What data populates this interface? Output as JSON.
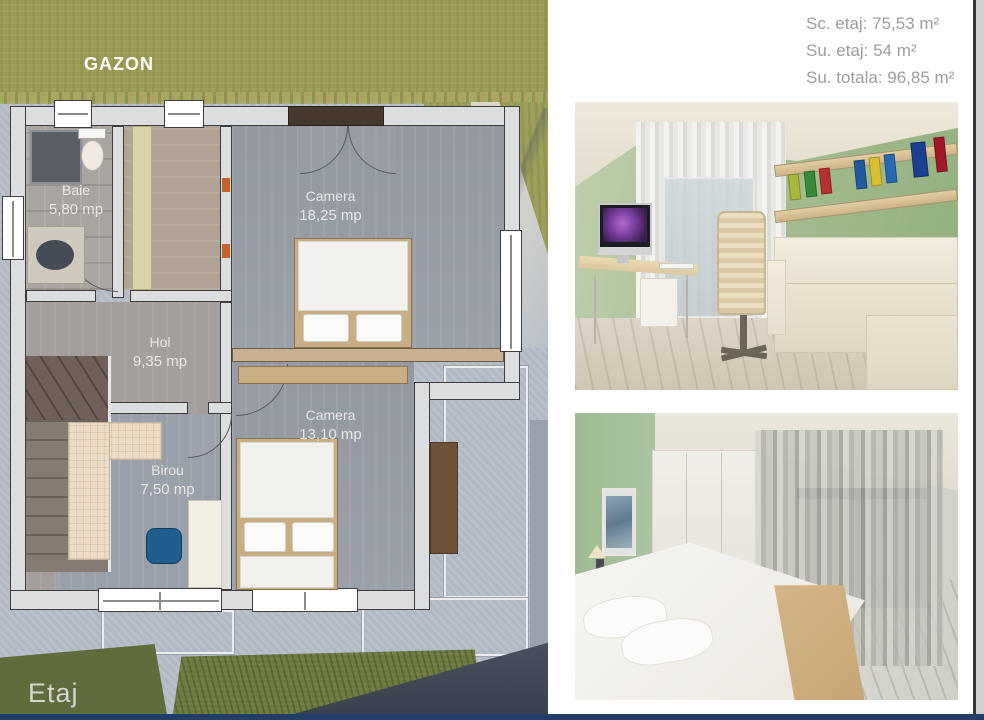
{
  "plan": {
    "garden_label": "GAZON",
    "floor_label": "Etaj",
    "rooms": {
      "baie": {
        "name": "Baie",
        "area": "5,80 mp"
      },
      "camera_mare": {
        "name": "Camera",
        "area": "18,25 mp"
      },
      "hol": {
        "name": "Hol",
        "area": "9,35 mp"
      },
      "camera_mica": {
        "name": "Camera",
        "area": "13,10 mp"
      },
      "birou": {
        "name": "Birou",
        "area": "7,50 mp"
      }
    }
  },
  "summary": {
    "sc_etaj": "Sc. etaj: 75,53 m²",
    "su_etaj": "Su. etaj: 54 m²",
    "su_totala": "Su. totala: 96,85 m²"
  },
  "colors": {
    "grass_top": "#9b9b58",
    "grass_dark": "#5f6c3c",
    "concrete": "#b5bdc8",
    "bottom_accent_line": "#213e6b",
    "summary_text": "#9d9d9d",
    "render_wall_green": "#a6bd92"
  }
}
